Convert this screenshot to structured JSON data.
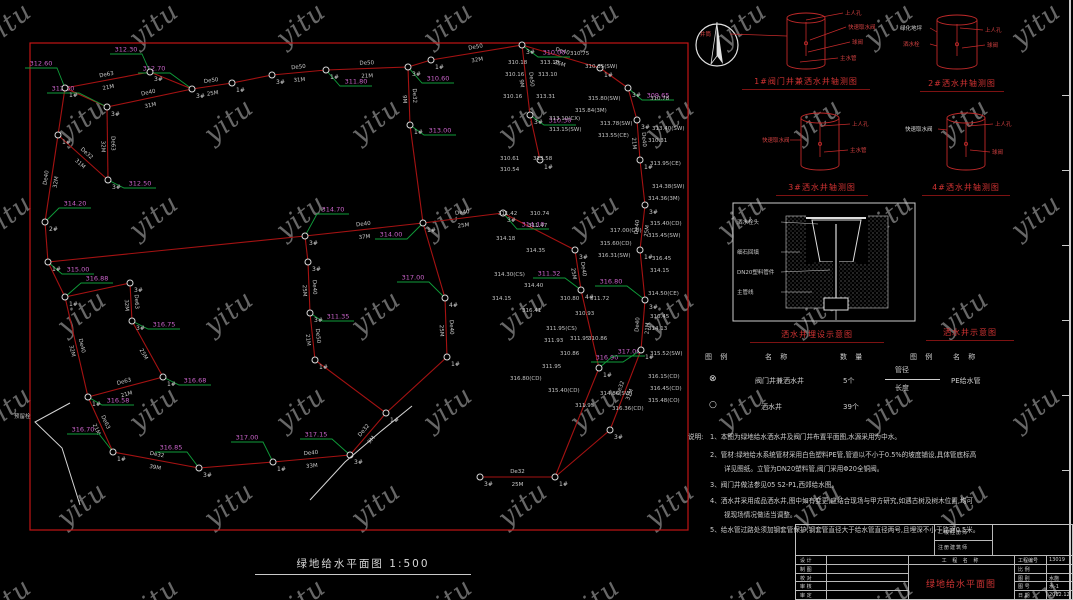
{
  "watermark": {
    "text": "yitu"
  },
  "colors": {
    "pipe": "#a51212",
    "border": "#c01515",
    "leader": "#0f9d3a",
    "elev": "#c863c8",
    "detail_red": "#c22a2a",
    "caption_red": "#d03232"
  },
  "plan": {
    "title": "绿地给水平面图 1:500",
    "border": {
      "x": 30,
      "y": 43,
      "w": 658,
      "h": 487
    },
    "source_tap_label": "预留栓",
    "nodes": [
      [
        65,
        88,
        "1#"
      ],
      [
        150,
        72,
        "3#"
      ],
      [
        192,
        89,
        "3#"
      ],
      [
        232,
        83,
        "1#"
      ],
      [
        272,
        75,
        "3#"
      ],
      [
        326,
        70,
        "1#"
      ],
      [
        408,
        67,
        "3#"
      ],
      [
        431,
        60,
        "1#"
      ],
      [
        522,
        45,
        "3#"
      ],
      [
        600,
        68,
        "1#"
      ],
      [
        628,
        88,
        "3#"
      ],
      [
        107,
        107,
        "3#"
      ],
      [
        58,
        135,
        "1#"
      ],
      [
        108,
        180,
        "3#"
      ],
      [
        45,
        222,
        "2#"
      ],
      [
        48,
        262,
        "1#"
      ],
      [
        65,
        297,
        "1#"
      ],
      [
        88,
        397,
        "1#"
      ],
      [
        130,
        283,
        "3#"
      ],
      [
        132,
        321,
        "3#"
      ],
      [
        163,
        377,
        "1#"
      ],
      [
        113,
        452,
        "1#"
      ],
      [
        199,
        468,
        "3#"
      ],
      [
        273,
        462,
        "1#"
      ],
      [
        350,
        455,
        "3#"
      ],
      [
        386,
        413,
        "1#"
      ],
      [
        480,
        477,
        "3#"
      ],
      [
        555,
        477,
        "1#"
      ],
      [
        610,
        430,
        "3#"
      ],
      [
        641,
        350,
        "1#"
      ],
      [
        645,
        300,
        "3#"
      ],
      [
        640,
        250,
        "1#"
      ],
      [
        645,
        205,
        "3#"
      ],
      [
        640,
        160,
        "1#"
      ],
      [
        637,
        120,
        "3#"
      ],
      [
        410,
        125,
        "1#"
      ],
      [
        530,
        115,
        "3#"
      ],
      [
        540,
        160,
        "1#"
      ],
      [
        575,
        250,
        "3#"
      ],
      [
        581,
        290,
        "4#"
      ],
      [
        599,
        368,
        "1#"
      ],
      [
        305,
        236,
        "3#"
      ],
      [
        423,
        223,
        "1#"
      ],
      [
        503,
        213,
        "3#"
      ],
      [
        308,
        262,
        "3#"
      ],
      [
        310,
        313,
        "3#"
      ],
      [
        315,
        360,
        "1#"
      ],
      [
        445,
        298,
        "4#"
      ],
      [
        447,
        357,
        "1#"
      ]
    ],
    "edges": [
      [
        0,
        1,
        "De63",
        "21M"
      ],
      [
        1,
        2,
        "",
        ""
      ],
      [
        2,
        3,
        "De50",
        "25M"
      ],
      [
        3,
        4,
        "",
        ""
      ],
      [
        4,
        5,
        "De50",
        "31M"
      ],
      [
        5,
        6,
        "De50",
        "21M"
      ],
      [
        6,
        7,
        "",
        ""
      ],
      [
        7,
        8,
        "De50",
        "32M"
      ],
      [
        8,
        9,
        "De40",
        "25M"
      ],
      [
        9,
        10,
        "",
        ""
      ],
      [
        10,
        34,
        "",
        ""
      ],
      [
        34,
        33,
        "De40",
        "21M"
      ],
      [
        33,
        32,
        "",
        ""
      ],
      [
        32,
        31,
        "De40",
        "25M"
      ],
      [
        31,
        30,
        "",
        ""
      ],
      [
        30,
        29,
        "De40",
        "21M"
      ],
      [
        29,
        28,
        "De32",
        "31M"
      ],
      [
        28,
        27,
        "",
        ""
      ],
      [
        27,
        26,
        "De32",
        "25M"
      ],
      [
        21,
        22,
        "De32",
        "39M"
      ],
      [
        22,
        23,
        "",
        ""
      ],
      [
        23,
        24,
        "De40",
        "33M"
      ],
      [
        24,
        25,
        "De32",
        "9M"
      ],
      [
        25,
        48,
        "",
        ""
      ],
      [
        48,
        47,
        "De40",
        "25M"
      ],
      [
        47,
        42,
        "",
        ""
      ],
      [
        41,
        42,
        "De40",
        "37M"
      ],
      [
        42,
        43,
        "De40",
        "25M"
      ],
      [
        43,
        38,
        "",
        ""
      ],
      [
        38,
        39,
        "De40",
        "25M"
      ],
      [
        39,
        40,
        "",
        ""
      ],
      [
        40,
        27,
        "",
        ""
      ],
      [
        36,
        37,
        "",
        ""
      ],
      [
        8,
        36,
        "De50",
        "9M"
      ],
      [
        6,
        35,
        "De32",
        "9M"
      ],
      [
        35,
        42,
        "",
        ""
      ],
      [
        0,
        11,
        "",
        ""
      ],
      [
        11,
        2,
        "De40",
        "31M"
      ],
      [
        11,
        13,
        "De63",
        "32M"
      ],
      [
        12,
        13,
        "De32",
        "31M"
      ],
      [
        0,
        12,
        "",
        ""
      ],
      [
        12,
        14,
        "De40",
        "32M"
      ],
      [
        14,
        15,
        "",
        ""
      ],
      [
        15,
        16,
        "",
        ""
      ],
      [
        16,
        17,
        "De40",
        "32M"
      ],
      [
        17,
        21,
        "De63",
        "21M"
      ],
      [
        16,
        18,
        "",
        ""
      ],
      [
        18,
        19,
        "De63",
        "32M"
      ],
      [
        19,
        20,
        "",
        "25M"
      ],
      [
        20,
        17,
        "De63",
        "21M"
      ],
      [
        15,
        41,
        "",
        ""
      ],
      [
        41,
        44,
        "",
        ""
      ],
      [
        44,
        45,
        "De40",
        "25M"
      ],
      [
        45,
        46,
        "De50",
        "21M"
      ],
      [
        46,
        25,
        "",
        ""
      ]
    ],
    "elevations": [
      [
        150,
        72,
        -8,
        -18,
        "312.30"
      ],
      [
        192,
        89,
        -22,
        -16,
        "312.70"
      ],
      [
        65,
        88,
        -8,
        -20,
        "312.60"
      ],
      [
        107,
        107,
        -28,
        -14,
        "312.60"
      ],
      [
        108,
        180,
        16,
        8,
        "312.50"
      ],
      [
        326,
        70,
        14,
        16,
        "311.80"
      ],
      [
        408,
        67,
        14,
        16,
        "310.60"
      ],
      [
        522,
        45,
        16,
        12,
        "310.00"
      ],
      [
        628,
        88,
        14,
        12,
        "309.65"
      ],
      [
        45,
        222,
        14,
        -14,
        "314.20"
      ],
      [
        48,
        262,
        14,
        12,
        "315.00"
      ],
      [
        305,
        236,
        12,
        -22,
        "314.70"
      ],
      [
        423,
        223,
        -16,
        16,
        "314.00"
      ],
      [
        503,
        213,
        14,
        16,
        "314.10"
      ],
      [
        445,
        298,
        -16,
        -16,
        "317.00"
      ],
      [
        65,
        297,
        16,
        -14,
        "316.88"
      ],
      [
        132,
        321,
        16,
        8,
        "316.75"
      ],
      [
        163,
        377,
        16,
        8,
        "316.68"
      ],
      [
        88,
        397,
        14,
        8,
        "316.58"
      ],
      [
        113,
        452,
        -14,
        -18,
        "316.70"
      ],
      [
        199,
        468,
        -12,
        -16,
        "316.85"
      ],
      [
        273,
        462,
        -10,
        -20,
        "317.00"
      ],
      [
        350,
        455,
        -18,
        -16,
        "317.15"
      ],
      [
        645,
        300,
        -18,
        -14,
        "316.80"
      ],
      [
        641,
        350,
        -18,
        12,
        "316.90"
      ],
      [
        599,
        368,
        14,
        -12,
        "317.00"
      ],
      [
        310,
        313,
        12,
        8,
        "311.35"
      ],
      [
        530,
        115,
        14,
        10,
        "310.30"
      ],
      [
        581,
        290,
        -16,
        -12,
        "311.32"
      ],
      [
        410,
        125,
        14,
        10,
        "313.00"
      ]
    ],
    "annotations": [
      [
        508,
        64,
        "310.18"
      ],
      [
        540,
        64,
        "313.18"
      ],
      [
        505,
        76,
        "310.16"
      ],
      [
        538,
        76,
        "313.10"
      ],
      [
        503,
        98,
        "310.16"
      ],
      [
        536,
        98,
        "313.31"
      ],
      [
        549,
        120,
        "313.10(CX)"
      ],
      [
        549,
        131,
        "313.15(SW)"
      ],
      [
        500,
        160,
        "310.61"
      ],
      [
        500,
        171,
        "310.54"
      ],
      [
        533,
        160,
        "313.58"
      ],
      [
        498,
        215,
        "311.42"
      ],
      [
        530,
        215,
        "310.74"
      ],
      [
        528,
        227,
        "311.47"
      ],
      [
        496,
        240,
        "314.18"
      ],
      [
        526,
        252,
        "314.35"
      ],
      [
        494,
        276,
        "314.30(CS)"
      ],
      [
        524,
        287,
        "314.40"
      ],
      [
        492,
        300,
        "314.15"
      ],
      [
        522,
        312,
        "316.41"
      ],
      [
        546,
        330,
        "311.95(CS)"
      ],
      [
        544,
        342,
        "311.93"
      ],
      [
        560,
        355,
        "310.86"
      ],
      [
        542,
        368,
        "311.95"
      ],
      [
        510,
        380,
        "316.80(CD)"
      ],
      [
        548,
        392,
        "315.40(CD)"
      ],
      [
        650,
        100,
        "310.78"
      ],
      [
        652,
        130,
        "313.40(SW)"
      ],
      [
        648,
        142,
        "310.31"
      ],
      [
        650,
        165,
        "313.95(CE)"
      ],
      [
        652,
        188,
        "314.38(SW)"
      ],
      [
        648,
        200,
        "314.36(3M)"
      ],
      [
        650,
        225,
        "315.40(CD)"
      ],
      [
        648,
        237,
        "315.45(SW)"
      ],
      [
        652,
        260,
        "316.45"
      ],
      [
        650,
        272,
        "314.15"
      ],
      [
        648,
        295,
        "314.50(CE)"
      ],
      [
        650,
        318,
        "316.45"
      ],
      [
        648,
        330,
        "314.13"
      ],
      [
        650,
        355,
        "315.52(SW)"
      ],
      [
        648,
        378,
        "316.15(CD)"
      ],
      [
        650,
        390,
        "316.45(CD)"
      ],
      [
        648,
        402,
        "315.48(CO)"
      ],
      [
        570,
        340,
        "311.95"
      ],
      [
        590,
        300,
        "311.72"
      ],
      [
        610,
        232,
        "317.00(CD)"
      ],
      [
        600,
        245,
        "315.60(CD)"
      ],
      [
        598,
        257,
        "316.31(SW)"
      ],
      [
        560,
        300,
        "310.80"
      ],
      [
        575,
        315,
        "310.93"
      ],
      [
        588,
        340,
        "310.86"
      ],
      [
        575,
        407,
        "311.95"
      ],
      [
        600,
        395,
        "314.86(SW)"
      ],
      [
        612,
        410,
        "316.36(CD)"
      ],
      [
        588,
        100,
        "315.80(SW)"
      ],
      [
        575,
        112,
        "315.84(3M)"
      ],
      [
        600,
        125,
        "313.78(SW)"
      ],
      [
        598,
        137,
        "313.55(CE)"
      ],
      [
        570,
        55,
        "310.75"
      ],
      [
        585,
        68,
        "310.35(SW)"
      ],
      [
        14,
        418,
        "预留栓"
      ]
    ],
    "white_paths": [
      [
        [
          70,
          403
        ],
        [
          35,
          422
        ],
        [
          62,
          448
        ],
        [
          80,
          505
        ]
      ],
      [
        [
          310,
          500
        ],
        [
          345,
          462
        ],
        [
          380,
          432
        ],
        [
          412,
          406
        ]
      ]
    ]
  },
  "details": {
    "items": [
      {
        "caption": "1#阀门井兼洒水井轴测图",
        "cx": 806,
        "cy": 18,
        "rx": 19,
        "h": 46,
        "labels": [
          {
            "t": "井筒",
            "x": 700,
            "y": 36,
            "a": "s"
          },
          {
            "t": "上人孔",
            "x": 845,
            "y": 15,
            "a": "s"
          },
          {
            "t": "快速取水阀",
            "x": 848,
            "y": 29,
            "a": "s"
          },
          {
            "t": "球阀",
            "x": 852,
            "y": 44,
            "a": "s"
          },
          {
            "t": "主水管",
            "x": 840,
            "y": 60,
            "a": "s"
          }
        ],
        "leaders": [
          [
            730,
            34,
            787,
            36
          ],
          [
            806,
            20,
            843,
            13
          ],
          [
            810,
            40,
            846,
            27
          ],
          [
            808,
            52,
            850,
            42
          ],
          [
            800,
            62,
            838,
            58
          ]
        ]
      },
      {
        "caption": "2#洒水井轴测图",
        "cx": 957,
        "cy": 20,
        "rx": 20,
        "h": 44,
        "labels": [
          {
            "t": "绿化地坪",
            "x": 900,
            "y": 30,
            "a": "s",
            "w": 1
          },
          {
            "t": "洒水栓",
            "x": 903,
            "y": 46,
            "a": "s"
          },
          {
            "t": "上人孔",
            "x": 985,
            "y": 32,
            "a": "s"
          },
          {
            "t": "球阀",
            "x": 987,
            "y": 47,
            "a": "s"
          }
        ],
        "leaders": [
          [
            930,
            28,
            937,
            32
          ],
          [
            930,
            44,
            937,
            46
          ],
          [
            960,
            28,
            983,
            30
          ],
          [
            962,
            48,
            985,
            45
          ]
        ]
      },
      {
        "caption": "3#洒水井轴测图",
        "cx": 820,
        "cy": 118,
        "rx": 19,
        "h": 47,
        "labels": [
          {
            "t": "快速取水阀",
            "x": 762,
            "y": 142,
            "a": "s"
          },
          {
            "t": "上人孔",
            "x": 852,
            "y": 126,
            "a": "s"
          },
          {
            "t": "主水管",
            "x": 850,
            "y": 152,
            "a": "s"
          }
        ],
        "leaders": [
          [
            790,
            140,
            801,
            140
          ],
          [
            822,
            126,
            850,
            124
          ],
          [
            824,
            152,
            848,
            150
          ]
        ]
      },
      {
        "caption": "4#洒水井轴测图",
        "cx": 966,
        "cy": 118,
        "rx": 19,
        "h": 47,
        "labels": [
          {
            "t": "快速取水阀",
            "x": 905,
            "y": 131,
            "a": "s",
            "w": 1
          },
          {
            "t": "上人孔",
            "x": 995,
            "y": 126,
            "a": "s"
          },
          {
            "t": "球阀",
            "x": 992,
            "y": 154,
            "a": "s"
          }
        ],
        "leaders": [
          [
            938,
            129,
            947,
            130
          ],
          [
            968,
            126,
            993,
            124
          ],
          [
            970,
            150,
            990,
            152
          ]
        ]
      }
    ]
  },
  "burial": {
    "caption": "洒水井埋设示意图",
    "labels": [
      "洒水栓头",
      "细石回填",
      "DN20塑料管件",
      "主管线"
    ]
  },
  "schematic": {
    "caption": "洒水井示意图"
  },
  "legend": {
    "headers": [
      "图 例",
      "名 称",
      "数 量",
      "图 例",
      "名 称"
    ],
    "rows": [
      {
        "sym": "⊗",
        "name": "阀门井兼洒水井",
        "qty": "5个"
      },
      {
        "sym": "○",
        "name": "洒水井",
        "qty": "39个"
      }
    ],
    "pipe": {
      "top": "管径",
      "bottom": "长度",
      "name": "PE给水管"
    }
  },
  "notes": {
    "title": "说明:",
    "lines": [
      "1、本图为绿地给水洒水井及阀门井布置平面图,水源采用为中水。",
      "2、管材:绿地给水系统管材采用白色塑料PE管,管道以不小于0.5%的坡度铺设,具体管底标高",
      "详见图纸。立管为DN20塑料管,阀门采用Φ20全铜阀。",
      "3、阀门井做法参见05 S2-P1,西郊给水图。",
      "4、洒水井采用成品洒水井,图中如有变更,应结合现场与甲方研究,如遇古树及树木位置,均可",
      "视现场情况做适当调整。",
      "5、给水管过路处须加钢套管保护,钢套管直径大于给水管直径两号,且埋深不小于路面0.5米。"
    ]
  },
  "titleblock": {
    "cert1": "二级注册师",
    "cert2": "注册建筑师",
    "sign_rows": [
      "设 计",
      "制 图",
      "校 对",
      "审 核",
      "审 定"
    ],
    "project_label": "工 程 名 称",
    "drawing_name": "绿地给水平面图",
    "fields": [
      [
        "工程编号",
        "13019"
      ],
      [
        "比  例",
        ""
      ],
      [
        "图  别",
        "水施"
      ],
      [
        "图  号",
        "水-1"
      ],
      [
        "日  期",
        "2012.12"
      ]
    ]
  }
}
